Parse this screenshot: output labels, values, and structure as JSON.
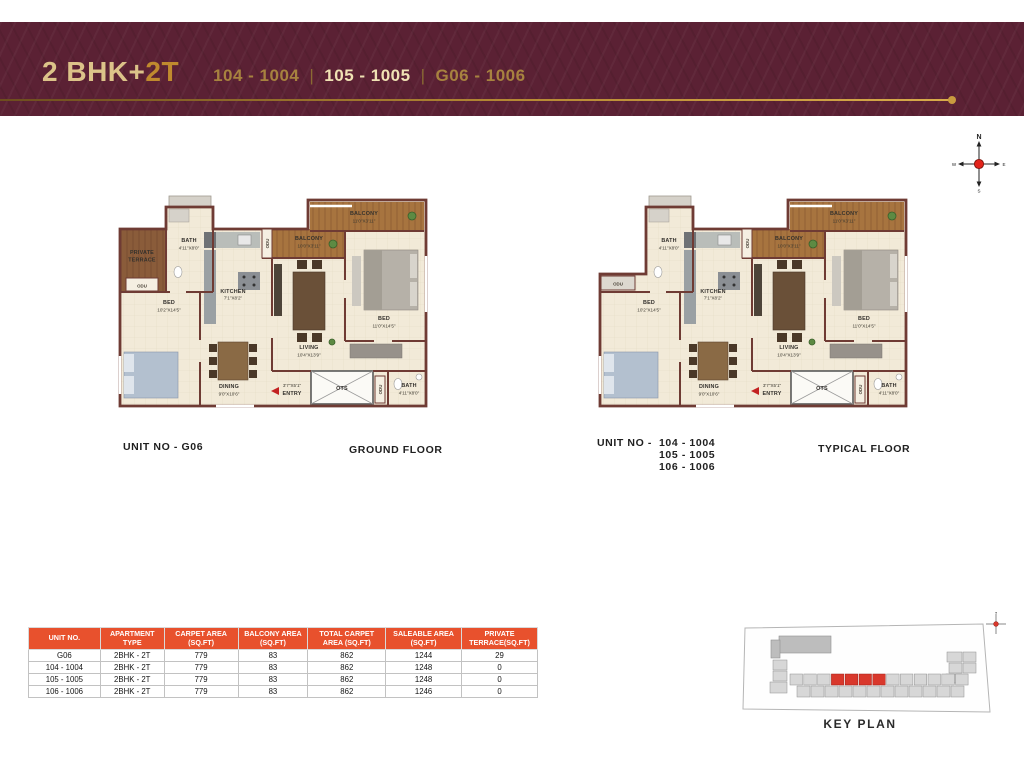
{
  "colors": {
    "banner_maroon": "#5b2134",
    "gold": "#c99b3f",
    "gold_highlight": "#f0e2b4",
    "table_header_orange": "#e8512d",
    "wall_brown": "#6f3b34",
    "floor_cream": "#f2ead8",
    "balcony_wood": "#a7743f",
    "terrace_brown": "#8a5c3a",
    "keyplan_red": "#d9382c"
  },
  "header": {
    "title_part1": "2 BHK+",
    "title_part2": "2T",
    "separator": "|",
    "unit_ranges": [
      "104 - 1004",
      "105 - 1005",
      "G06 - 1006"
    ]
  },
  "compass": {
    "north": "N",
    "east": "E",
    "south": "S",
    "west": "W"
  },
  "plans": [
    {
      "unit_caption": "UNIT NO - G06",
      "floor_caption": "GROUND FLOOR",
      "labels": {
        "balcony_top": "BALCONY",
        "balcony_top_dim": "11'0\"X3'11\"",
        "balcony_mid": "BALCONY",
        "balcony_mid_dim": "10'0\"X3'11\"",
        "bath_top": "BATH",
        "bath_top_dim": "4'11\"X8'0\"",
        "terrace_line1": "PRIVATE",
        "terrace_line2": "TERRACE",
        "odu_terrace": "ODU",
        "odu_balcony": "ODU",
        "odu_ots": "ODU",
        "bed_left": "BED",
        "bed_left_dim": "10'2\"X14'5\"",
        "kitchen": "KITCHEN",
        "kitchen_dim": "7'1\"X8'2\"",
        "living": "LIVING",
        "living_dim": "10'4\"X13'9\"",
        "bed_right": "BED",
        "bed_right_dim": "11'0\"X14'5\"",
        "dining": "DINING",
        "dining_dim": "9'0\"X10'6\"",
        "entry_dim": "3'7\"X5'1\"",
        "entry": "ENTRY",
        "ots": "OTS",
        "bath_bottom": "BATH",
        "bath_bottom_dim": "4'11\"X8'0\""
      }
    },
    {
      "unit_caption_prefix": "UNIT NO -",
      "unit_caption_lines": [
        "104 - 1004",
        "105 - 1005",
        "106 - 1006"
      ],
      "floor_caption": "TYPICAL FLOOR",
      "labels": {
        "balcony_top": "BALCONY",
        "balcony_top_dim": "11'0\"X3'11\"",
        "balcony_mid": "BALCONY",
        "balcony_mid_dim": "10'0\"X3'11\"",
        "bath_top": "BATH",
        "bath_top_dim": "4'11\"X8'0\"",
        "odu_unit": "ODU",
        "odu_balcony": "ODU",
        "odu_ots": "ODU",
        "bed_left": "BED",
        "bed_left_dim": "10'2\"X14'5\"",
        "kitchen": "KITCHEN",
        "kitchen_dim": "7'1\"X8'2\"",
        "living": "LIVING",
        "living_dim": "10'4\"X13'9\"",
        "bed_right": "BED",
        "bed_right_dim": "11'0\"X14'5\"",
        "dining": "DINING",
        "dining_dim": "9'0\"X10'6\"",
        "entry_dim": "3'7\"X5'1\"",
        "entry": "ENTRY",
        "ots": "OTS",
        "bath_bottom": "BATH",
        "bath_bottom_dim": "4'11\"X8'0\""
      }
    }
  ],
  "table": {
    "headers": [
      "UNIT NO.",
      "APARTMENT TYPE",
      "CARPET AREA (SQ.FT)",
      "BALCONY AREA (SQ.FT)",
      "TOTAL CARPET AREA (SQ.FT)",
      "SALEABLE AREA (SQ.FT)",
      "PRIVATE TERRACE(SQ.FT)"
    ],
    "rows": [
      [
        "G06",
        "2BHK - 2T",
        "779",
        "83",
        "862",
        "1244",
        "29"
      ],
      [
        "104 - 1004",
        "2BHK - 2T",
        "779",
        "83",
        "862",
        "1248",
        "0"
      ],
      [
        "105 - 1005",
        "2BHK - 2T",
        "779",
        "83",
        "862",
        "1248",
        "0"
      ],
      [
        "106 - 1006",
        "2BHK - 2T",
        "779",
        "83",
        "862",
        "1246",
        "0"
      ]
    ]
  },
  "key_plan": {
    "caption": "KEY PLAN"
  }
}
